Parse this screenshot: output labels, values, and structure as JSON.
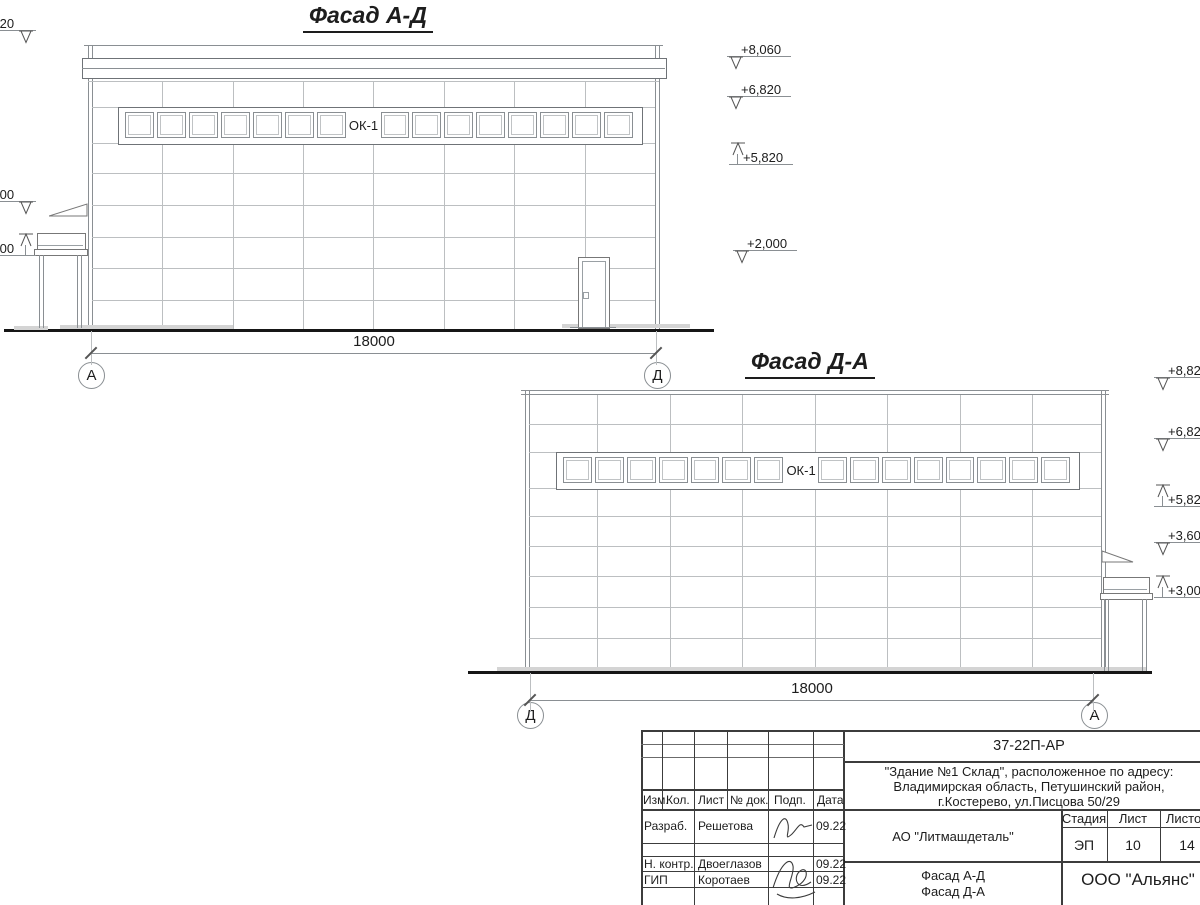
{
  "drawing": {
    "facade_ad": {
      "title": "Фасад А-Д",
      "window_label": "ОК-1",
      "dimension_label": "18000",
      "axis_start": "А",
      "axis_end": "Д",
      "elevation_marks_left": [
        "+8,820",
        "+3,600",
        "+3,000"
      ],
      "elevation_marks_right": [
        "+8,060",
        "+6,820",
        "+5,820",
        "+2,000"
      ]
    },
    "facade_da": {
      "title": "Фасад Д-А",
      "window_label": "ОК-1",
      "dimension_label": "18000",
      "axis_start": "Д",
      "axis_end": "А",
      "elevation_marks_right": [
        "+8,820",
        "+6,820",
        "+5,820",
        "+3,600",
        "+3,000"
      ]
    }
  },
  "title_block": {
    "doc_number": "37-22П-АР",
    "project_lines": [
      "\"Здание №1 Склад\", расположенное по адресу:",
      "Владимирская область, Петушинский район,",
      "г.Костерево, ул.Писцова 50/29"
    ],
    "client": "АО \"Литмашдеталь\"",
    "sheet_content_lines": [
      "Фасад А-Д",
      "Фасад Д-А"
    ],
    "company": "ООО \"Альянс\"",
    "stage_label": "Стадия",
    "sheet_label": "Лист",
    "total_label": "Листов",
    "stage_value": "ЭП",
    "sheet_value": "10",
    "total_value": "14",
    "rev_columns": [
      "Изм.",
      "Кол.",
      "Лист",
      "№ док.",
      "Подп.",
      "Дата"
    ],
    "signature_rows": [
      {
        "role": "Разраб.",
        "name": "Решетова",
        "date": "09.22"
      },
      {
        "role": "Н. контр.",
        "name": "Двоеглазов",
        "date": "09.22"
      },
      {
        "role": "ГИП",
        "name": "Коротаев",
        "date": "09.22"
      }
    ]
  }
}
